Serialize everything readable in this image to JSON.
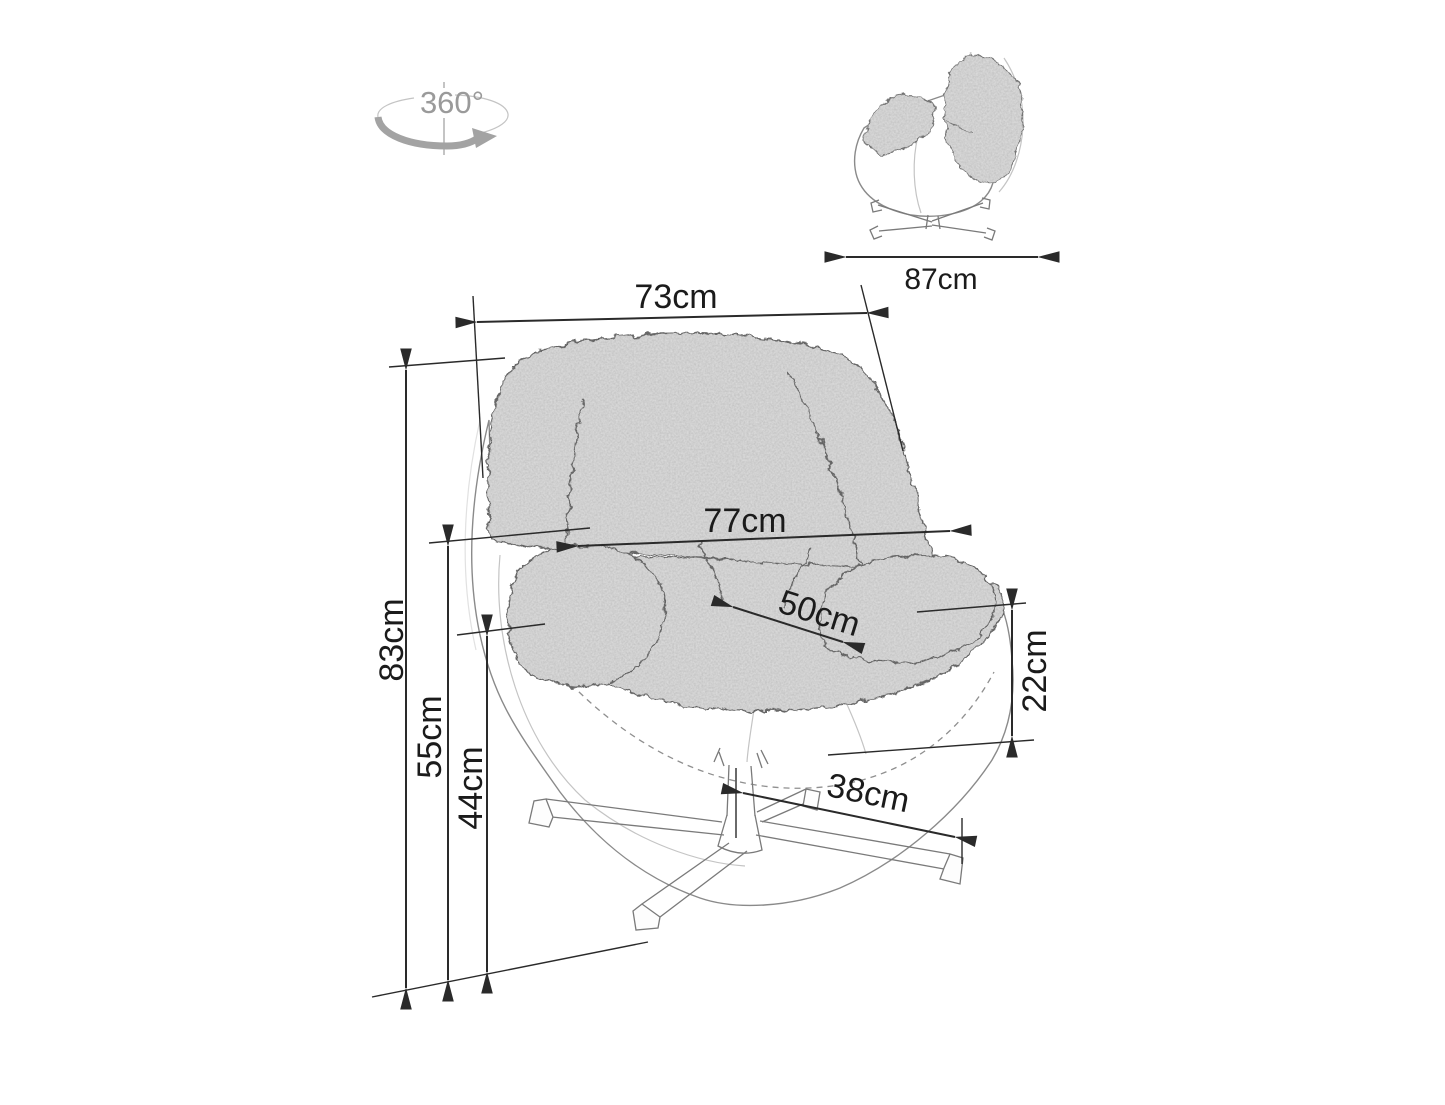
{
  "canvas": {
    "width_px": 1445,
    "height_px": 1105,
    "background": "#ffffff"
  },
  "colors": {
    "dimension_line": "#2a2a2a",
    "label_text": "#1b1b1b",
    "sketch_outline": "#8a8a8a",
    "cushion_fill": "#e0e0e0",
    "rotation_gray": "#9a9a9a"
  },
  "rotation_indicator": {
    "label": "360°"
  },
  "side_view": {
    "description": "side profile sketch of swivel tub chair",
    "overall_depth": {
      "label": "87cm",
      "value": 87,
      "unit": "cm"
    }
  },
  "main_view": {
    "description": "three-quarter sketch of swivel tub chair with star base",
    "back_width": {
      "label": "73cm",
      "value": 73,
      "unit": "cm"
    },
    "overall_width": {
      "label": "77cm",
      "value": 77,
      "unit": "cm"
    },
    "seat_depth": {
      "label": "50cm",
      "value": 50,
      "unit": "cm"
    },
    "overall_height": {
      "label": "83cm",
      "value": 83,
      "unit": "cm"
    },
    "armrest_height": {
      "label": "55cm",
      "value": 55,
      "unit": "cm"
    },
    "seat_height": {
      "label": "44cm",
      "value": 44,
      "unit": "cm"
    },
    "seat_edge_to_shell_bottom": {
      "label": "22cm",
      "value": 22,
      "unit": "cm"
    },
    "base_leg_length": {
      "label": "38cm",
      "value": 38,
      "unit": "cm"
    }
  }
}
